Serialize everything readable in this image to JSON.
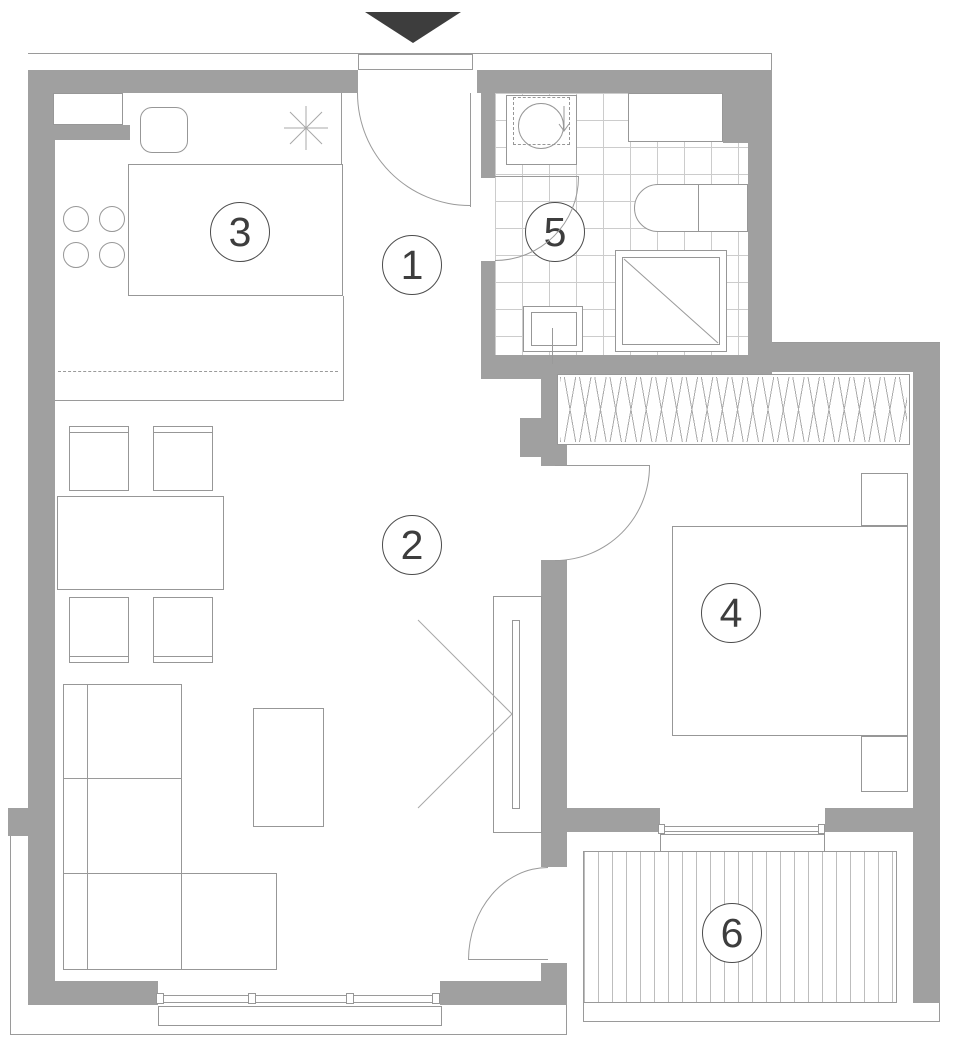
{
  "plan": {
    "room_labels": [
      "1",
      "2",
      "3",
      "4",
      "5",
      "6"
    ],
    "colors": {
      "wall": "#a0a0a0",
      "line": "#9a9a9a",
      "entrance_marker": "#3d3d3d"
    },
    "icons": {
      "entrance_marker": "down-triangle",
      "stove_symbol": "asterisk",
      "washer_symbol": "circle-with-arrow",
      "shower_symbol": "square-with-diagonal",
      "tv_symbol": "viewing-angle-v"
    }
  }
}
